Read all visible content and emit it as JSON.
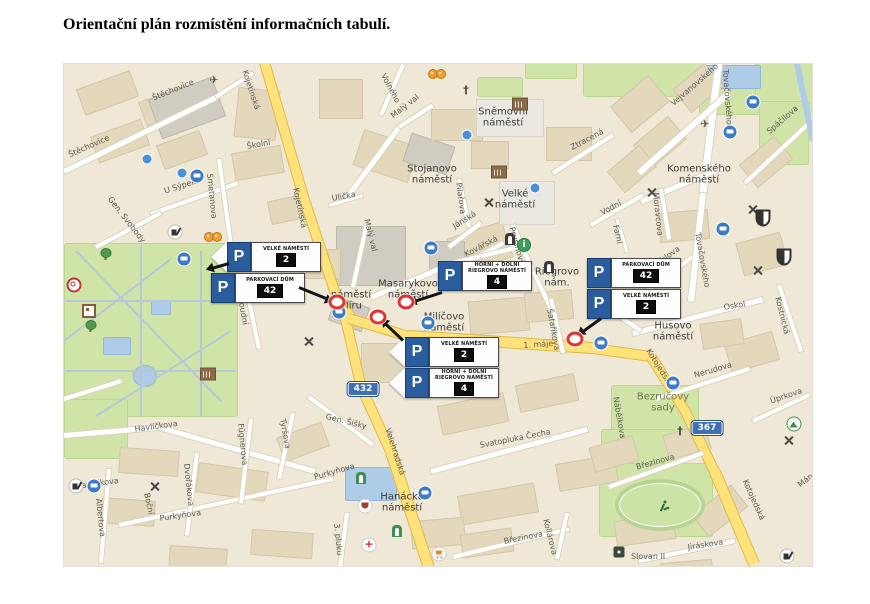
{
  "title": "Orientační plán rozmístění informačních tabulí.",
  "map": {
    "street_labels": [
      {
        "t": "Štěchovice",
        "x": 150,
        "y": 93,
        "r": -22
      },
      {
        "t": "Štěchovice",
        "x": 66,
        "y": 150,
        "r": -24
      },
      {
        "t": "Kojetínská",
        "x": 248,
        "y": 68,
        "r": 72
      },
      {
        "t": "Kojetínská",
        "x": 299,
        "y": 186,
        "r": 78
      },
      {
        "t": "Školní",
        "x": 245,
        "y": 141,
        "r": -10
      },
      {
        "t": "U Sýpek",
        "x": 162,
        "y": 186,
        "r": -18
      },
      {
        "t": "Smetanova",
        "x": 213,
        "y": 172,
        "r": 84
      },
      {
        "t": "Gen. Svobody",
        "x": 112,
        "y": 194,
        "r": 52
      },
      {
        "t": "Soudní",
        "x": 244,
        "y": 296,
        "r": 80
      },
      {
        "t": "Havlíčkova",
        "x": 133,
        "y": 424,
        "r": -8
      },
      {
        "t": "Havlíčkova",
        "x": 74,
        "y": 481,
        "r": -8
      },
      {
        "t": "Tyršova",
        "x": 286,
        "y": 417,
        "r": 80
      },
      {
        "t": "Purkyňova",
        "x": 158,
        "y": 513,
        "r": -8
      },
      {
        "t": "Purkyňova",
        "x": 312,
        "y": 472,
        "r": -16
      },
      {
        "t": "Dvořákova",
        "x": 190,
        "y": 462,
        "r": 84
      },
      {
        "t": "Fügnerova",
        "x": 244,
        "y": 422,
        "r": 84
      },
      {
        "t": "Albertova",
        "x": 102,
        "y": 497,
        "r": 84
      },
      {
        "t": "Boční",
        "x": 150,
        "y": 491,
        "r": 78
      },
      {
        "t": "3. pluku",
        "x": 340,
        "y": 522,
        "r": 84
      },
      {
        "t": "Gen. Šišky",
        "x": 326,
        "y": 411,
        "r": 14
      },
      {
        "t": "Velehradská",
        "x": 391,
        "y": 426,
        "r": 72
      },
      {
        "t": "Svatopluka Čecha",
        "x": 478,
        "y": 440,
        "r": -11
      },
      {
        "t": "Březinova",
        "x": 502,
        "y": 536,
        "r": -11
      },
      {
        "t": "Březinova",
        "x": 634,
        "y": 462,
        "r": -16
      },
      {
        "t": "Kollárova",
        "x": 549,
        "y": 517,
        "r": 76
      },
      {
        "t": "Jiráskova",
        "x": 686,
        "y": 542,
        "r": -9
      },
      {
        "t": "Kotojedská",
        "x": 651,
        "y": 346,
        "r": 58
      },
      {
        "t": "Kotojedská",
        "x": 748,
        "y": 477,
        "r": 66
      },
      {
        "t": "Nerudova",
        "x": 692,
        "y": 370,
        "r": -16
      },
      {
        "t": "Úprkova",
        "x": 768,
        "y": 396,
        "r": -19
      },
      {
        "t": "Mánesova",
        "x": 795,
        "y": 481,
        "r": -38
      },
      {
        "t": "Oskol",
        "x": 722,
        "y": 302,
        "r": -9
      },
      {
        "t": "Kostnická",
        "x": 781,
        "y": 295,
        "r": 76
      },
      {
        "t": "Nábělkova",
        "x": 619,
        "y": 395,
        "r": 80
      },
      {
        "t": "Tylova",
        "x": 655,
        "y": 258,
        "r": -36
      },
      {
        "t": "Tovačovského",
        "x": 729,
        "y": 68,
        "r": 86
      },
      {
        "t": "Tovačovského",
        "x": 701,
        "y": 231,
        "r": 80
      },
      {
        "t": "Vejvanovského",
        "x": 668,
        "y": 100,
        "r": -41
      },
      {
        "t": "Spáčilova",
        "x": 764,
        "y": 128,
        "r": -41
      },
      {
        "t": "Moravcova",
        "x": 659,
        "y": 191,
        "r": 84
      },
      {
        "t": "Vodní",
        "x": 598,
        "y": 208,
        "r": -28
      },
      {
        "t": "Farní",
        "x": 619,
        "y": 223,
        "r": 78
      },
      {
        "t": "Ztracená",
        "x": 568,
        "y": 143,
        "r": -28
      },
      {
        "t": "Malý val",
        "x": 388,
        "y": 112,
        "r": -38
      },
      {
        "t": "Malý val",
        "x": 370,
        "y": 217,
        "r": 76
      },
      {
        "t": "Volného",
        "x": 386,
        "y": 71,
        "r": 62
      },
      {
        "t": "Ulička",
        "x": 330,
        "y": 193,
        "r": -10
      },
      {
        "t": "Jánská",
        "x": 450,
        "y": 222,
        "r": -32
      },
      {
        "t": "Kovářská",
        "x": 462,
        "y": 250,
        "r": -28
      },
      {
        "t": "Prusinovského",
        "x": 515,
        "y": 225,
        "r": 74
      },
      {
        "t": "Pilařova",
        "x": 462,
        "y": 181,
        "r": 82
      },
      {
        "t": "Šafaříkova",
        "x": 553,
        "y": 307,
        "r": 80
      },
      {
        "t": "1. máje",
        "x": 522,
        "y": 340,
        "r": -4
      },
      {
        "t": "Slovan II",
        "x": 630,
        "y": 551,
        "r": 0
      }
    ],
    "square_labels": [
      {
        "t": "Sněmovní náměstí",
        "x": 502,
        "y": 117
      },
      {
        "t": "Stojanovo náměstí",
        "x": 431,
        "y": 174
      },
      {
        "t": "Velké náměstí",
        "x": 514,
        "y": 199
      },
      {
        "t": "Komenského náměstí",
        "x": 698,
        "y": 174
      },
      {
        "t": "Masarykovo náměstí",
        "x": 407,
        "y": 289
      },
      {
        "t": "náměstí Míru",
        "x": 350,
        "y": 300
      },
      {
        "t": "Milíčovo náměstí",
        "x": 443,
        "y": 322
      },
      {
        "t": "Husovo náměstí",
        "x": 672,
        "y": 331
      },
      {
        "t": "Hanácké náměstí",
        "x": 401,
        "y": 502
      },
      {
        "t": "Riegrovo nám.",
        "x": 556,
        "y": 277
      },
      {
        "t": "Bezručovy sady",
        "x": 662,
        "y": 402,
        "green": true
      }
    ],
    "road_shields": [
      {
        "t": "432",
        "x": 362,
        "y": 388
      },
      {
        "t": "367",
        "x": 706,
        "y": 427
      }
    ],
    "signs": {
      "p_letter": "P",
      "clusters": [
        {
          "x": 210,
          "y": 241,
          "rows": [
            {
              "title": "VELKÉ NÁMĚSTÍ",
              "number": "2",
              "wedge": true
            },
            {
              "title": "PARKOVACÍ DŮM",
              "number": "42",
              "wedge": false
            }
          ]
        },
        {
          "x": 437,
          "y": 260,
          "rows": [
            {
              "title": "HORNÍ + DOLNÍ RIEGROVO NÁMĚSTÍ",
              "number": "4",
              "wedge": false
            }
          ]
        },
        {
          "x": 388,
          "y": 336,
          "rows": [
            {
              "title": "VELKÉ NÁMĚSTÍ",
              "number": "2",
              "wedge": true
            },
            {
              "title": "HORNÍ + DOLNÍ RIEGROVO NÁMĚSTÍ",
              "number": "4",
              "wedge": true
            }
          ]
        },
        {
          "x": 586,
          "y": 257,
          "rows": [
            {
              "title": "PARKOVACÍ DŮM",
              "number": "42",
              "wedge": false
            },
            {
              "title": "VELKÉ NÁMĚSTÍ",
              "number": "2",
              "wedge": false
            }
          ]
        }
      ]
    },
    "markers": [
      {
        "x": 336,
        "y": 301
      },
      {
        "x": 377,
        "y": 316
      },
      {
        "x": 405,
        "y": 301
      },
      {
        "x": 574,
        "y": 338
      }
    ],
    "arrows": [
      {
        "x1": 298,
        "y1": 286,
        "x2": 330,
        "y2": 299
      },
      {
        "x1": 402,
        "y1": 339,
        "x2": 381,
        "y2": 319
      },
      {
        "x1": 441,
        "y1": 291,
        "x2": 410,
        "y2": 301
      },
      {
        "x1": 600,
        "y1": 317,
        "x2": 578,
        "y2": 333
      },
      {
        "x1": 228,
        "y1": 262,
        "x2": 207,
        "y2": 268
      }
    ],
    "icons": [
      {
        "n": "bus-icon",
        "x": 196,
        "y": 175
      },
      {
        "n": "bus-icon",
        "x": 183,
        "y": 258
      },
      {
        "n": "bus-icon",
        "x": 93,
        "y": 485
      },
      {
        "n": "bus-icon",
        "x": 430,
        "y": 247
      },
      {
        "n": "bus-icon",
        "x": 427,
        "y": 322
      },
      {
        "n": "bus-icon",
        "x": 600,
        "y": 342
      },
      {
        "n": "bus-icon",
        "x": 672,
        "y": 382
      },
      {
        "n": "bus-icon",
        "x": 729,
        "y": 131
      },
      {
        "n": "bus-icon",
        "x": 752,
        "y": 101
      },
      {
        "n": "bus-icon",
        "x": 722,
        "y": 228
      },
      {
        "n": "bus-icon",
        "x": 424,
        "y": 492
      },
      {
        "n": "bus-icon",
        "x": 338,
        "y": 311
      },
      {
        "n": "restaurant-icon",
        "x": 308,
        "y": 341
      },
      {
        "n": "restaurant-icon",
        "x": 488,
        "y": 202
      },
      {
        "n": "restaurant-icon",
        "x": 651,
        "y": 192
      },
      {
        "n": "restaurant-icon",
        "x": 752,
        "y": 209
      },
      {
        "n": "restaurant-icon",
        "x": 757,
        "y": 270
      },
      {
        "n": "restaurant-icon",
        "x": 788,
        "y": 440
      },
      {
        "n": "restaurant-icon",
        "x": 154,
        "y": 486
      },
      {
        "n": "airplane-icon",
        "x": 213,
        "y": 77
      },
      {
        "n": "airplane-icon",
        "x": 704,
        "y": 121
      },
      {
        "n": "gears-icon",
        "x": 213,
        "y": 236
      },
      {
        "n": "gears-icon",
        "x": 437,
        "y": 73
      },
      {
        "n": "church-icon",
        "x": 465,
        "y": 87
      },
      {
        "n": "church-icon",
        "x": 679,
        "y": 428
      },
      {
        "n": "museum-icon",
        "x": 519,
        "y": 103
      },
      {
        "n": "museum-icon",
        "x": 498,
        "y": 171
      },
      {
        "n": "museum-icon",
        "x": 207,
        "y": 373
      },
      {
        "n": "gate-icon",
        "x": 548,
        "y": 266
      },
      {
        "n": "gate-icon",
        "x": 509,
        "y": 238
      },
      {
        "n": "door-icon",
        "x": 360,
        "y": 477
      },
      {
        "n": "door-icon",
        "x": 396,
        "y": 530
      },
      {
        "n": "mountain-icon",
        "x": 793,
        "y": 423
      },
      {
        "n": "crest-icon",
        "x": 762,
        "y": 217
      },
      {
        "n": "crest-icon",
        "x": 783,
        "y": 256
      },
      {
        "n": "info-icon",
        "x": 523,
        "y": 244
      },
      {
        "n": "poi-icon",
        "x": 146,
        "y": 158
      },
      {
        "n": "poi-icon",
        "x": 181,
        "y": 172
      },
      {
        "n": "poi-icon",
        "x": 466,
        "y": 134
      },
      {
        "n": "poi-icon",
        "x": 534,
        "y": 187
      },
      {
        "n": "hospital-icon",
        "x": 368,
        "y": 544
      },
      {
        "n": "cart-icon",
        "x": 438,
        "y": 553
      },
      {
        "n": "theater-icon",
        "x": 364,
        "y": 505
      },
      {
        "n": "runner-icon",
        "x": 663,
        "y": 505
      },
      {
        "n": "trash-icon",
        "x": 174,
        "y": 231
      },
      {
        "n": "trash-icon",
        "x": 75,
        "y": 485
      },
      {
        "n": "trash-icon",
        "x": 786,
        "y": 555
      },
      {
        "n": "tree-icon",
        "x": 104,
        "y": 253
      },
      {
        "n": "tree-icon",
        "x": 89,
        "y": 325
      },
      {
        "n": "rotunda-icon",
        "x": 73,
        "y": 284
      },
      {
        "n": "maze-icon",
        "x": 88,
        "y": 310
      },
      {
        "n": "slovan-icon",
        "x": 618,
        "y": 551
      }
    ]
  }
}
